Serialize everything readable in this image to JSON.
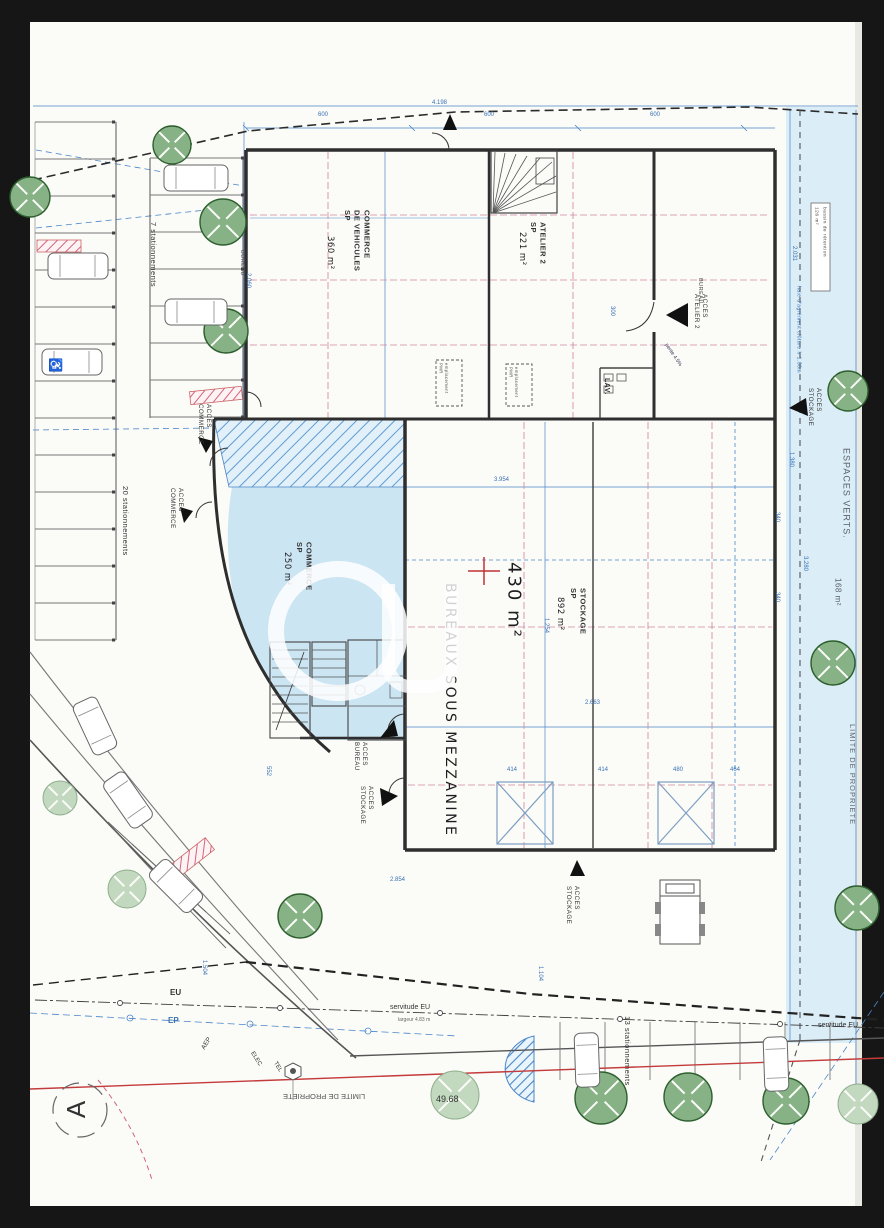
{
  "document": {
    "kind": "scanned site plan",
    "paper_color": "#fbfbf8",
    "frame_color": "#161616"
  },
  "colors": {
    "wall": "#2e2e2e",
    "blue_line": "#4a86c8",
    "blue_text": "#3a72b4",
    "pink_dash": "#d588a2",
    "red_line": "#c33b3b",
    "tree_dark": "#86b286",
    "tree_light": "#c2d9bf",
    "area_fill": "#cce5f2",
    "band_fill": "#dbedf7"
  },
  "labels": {
    "commerce_vehicules": "COMMERCE\nDE VEHICULES\nSP",
    "commerce_vehicules_area": "360 m²",
    "atelier2": "ATELIER 2\nSP",
    "atelier2_area": "221 m²",
    "stockage": "STOCKAGE\nSP",
    "stockage_area": "892 m²",
    "commerce": "COMMERCE\nSP",
    "commerce_area": "250 m²",
    "bureaux_mezzanine": "BUREAUX SOUS MEZZANINE",
    "bureaux_area": "430 m²",
    "lav": "LAV.",
    "bureau_1": "BUREAU",
    "bureau_2": "BUREAU",
    "acces_commerce_1": "ACCES\nCOMMERCE",
    "acces_commerce_2": "ACCES\nCOMMERCE",
    "acces_bureau": "ACCES\nBUREAU",
    "acces_stockage_1": "ACCES\nSTOCKAGE",
    "acces_stockage_2": "ACCES\nSTOCKAGE",
    "acces_stockage_3": "ACCES\nSTOCKAGE",
    "acces_atelier2": "ACCES\nATELIER 2",
    "espaces_verts": "ESPACES VERTS.",
    "espaces_verts_area": "168 m²",
    "limite_droite": "LIMITE DE PROPRIETE",
    "limite_bas": "LIMITE DE PROPRIETE",
    "bassin": "bassin de rétention\n126 m²",
    "haie": "haie d'agrément clôture h 1.80m",
    "stat_20": "20 stationnements",
    "stat_7": "7 stationnements",
    "stat_13": "13 stationnements",
    "servitude_eu_1": "servitude EU",
    "servitude_eu_2": "servitude EU",
    "servitude_note": "largeur 4.83 m",
    "eu": "EU",
    "ep": "EP",
    "cote_4968": "49.68",
    "aep": "AEP",
    "elec": "ELEC",
    "tel": "TEL",
    "pente": "pente 4.5%",
    "pmr_1": "emplacement\nPMR",
    "pmr_2": "emplacement\nPMR",
    "north": "A",
    "wheelchair": "♿"
  },
  "dim_labels": [
    {
      "t": "600",
      "x": 318,
      "y": 112,
      "r": 0
    },
    {
      "t": "600",
      "x": 484,
      "y": 112,
      "r": 0
    },
    {
      "t": "600",
      "x": 650,
      "y": 112,
      "r": 0
    },
    {
      "t": "4.198",
      "x": 432,
      "y": 100,
      "r": 0
    },
    {
      "t": "3.954",
      "x": 494,
      "y": 477,
      "r": 0
    },
    {
      "t": "1.254",
      "x": 549,
      "y": 618,
      "r": 90
    },
    {
      "t": "2.663",
      "x": 585,
      "y": 700,
      "r": 0
    },
    {
      "t": "414",
      "x": 507,
      "y": 767,
      "r": 0
    },
    {
      "t": "414",
      "x": 598,
      "y": 767,
      "r": 0
    },
    {
      "t": "480",
      "x": 673,
      "y": 767,
      "r": 0
    },
    {
      "t": "464",
      "x": 730,
      "y": 767,
      "r": 0
    },
    {
      "t": "340",
      "x": 780,
      "y": 512,
      "r": 90
    },
    {
      "t": "340",
      "x": 780,
      "y": 592,
      "r": 90
    },
    {
      "t": "2.031",
      "x": 797,
      "y": 246,
      "r": 90
    },
    {
      "t": "1.380",
      "x": 794,
      "y": 452,
      "r": 90
    },
    {
      "t": "2.060",
      "x": 251,
      "y": 273,
      "r": 90
    },
    {
      "t": "300",
      "x": 615,
      "y": 306,
      "r": 90
    },
    {
      "t": "1.504",
      "x": 207,
      "y": 960,
      "r": 90
    },
    {
      "t": "552",
      "x": 271,
      "y": 766,
      "r": 90
    },
    {
      "t": "3.280",
      "x": 808,
      "y": 556,
      "r": 90
    },
    {
      "t": "1.104",
      "x": 543,
      "y": 966,
      "r": 90
    },
    {
      "t": "2.854",
      "x": 390,
      "y": 877,
      "r": 0
    }
  ],
  "trees": [
    {
      "x": 172,
      "y": 145,
      "r": 19,
      "light": false
    },
    {
      "x": 30,
      "y": 197,
      "r": 20,
      "light": false
    },
    {
      "x": 223,
      "y": 222,
      "r": 23,
      "light": false
    },
    {
      "x": 226,
      "y": 331,
      "r": 22,
      "light": false
    },
    {
      "x": 848,
      "y": 391,
      "r": 20,
      "light": false
    },
    {
      "x": 833,
      "y": 663,
      "r": 22,
      "light": false
    },
    {
      "x": 857,
      "y": 908,
      "r": 22,
      "light": false
    },
    {
      "x": 300,
      "y": 916,
      "r": 22,
      "light": false
    },
    {
      "x": 601,
      "y": 1098,
      "r": 26,
      "light": false
    },
    {
      "x": 688,
      "y": 1097,
      "r": 24,
      "light": false
    },
    {
      "x": 786,
      "y": 1101,
      "r": 23,
      "light": false
    },
    {
      "x": 60,
      "y": 798,
      "r": 17,
      "light": true
    },
    {
      "x": 127,
      "y": 889,
      "r": 19,
      "light": true
    },
    {
      "x": 455,
      "y": 1095,
      "r": 24,
      "light": true
    },
    {
      "x": 858,
      "y": 1104,
      "r": 20,
      "light": true
    }
  ],
  "cars": [
    {
      "x": 196,
      "y": 178,
      "w": 64,
      "h": 26,
      "r": 0
    },
    {
      "x": 78,
      "y": 266,
      "w": 60,
      "h": 26,
      "r": 0
    },
    {
      "x": 72,
      "y": 362,
      "w": 60,
      "h": 26,
      "r": 0
    },
    {
      "x": 196,
      "y": 312,
      "w": 62,
      "h": 26,
      "r": 0
    },
    {
      "x": 95,
      "y": 726,
      "w": 56,
      "h": 26,
      "r": 65
    },
    {
      "x": 128,
      "y": 800,
      "w": 56,
      "h": 26,
      "r": 55
    },
    {
      "x": 176,
      "y": 886,
      "w": 56,
      "h": 26,
      "r": 45
    },
    {
      "x": 587,
      "y": 1060,
      "w": 54,
      "h": 24,
      "r": 88
    },
    {
      "x": 776,
      "y": 1064,
      "w": 54,
      "h": 24,
      "r": 88
    }
  ],
  "parking_rows": [
    {
      "dir": "h",
      "x": 35,
      "len": 81,
      "y0": 122,
      "step": 37,
      "n": 15,
      "dot": 112
    },
    {
      "dir": "h",
      "x": 150,
      "len": 93,
      "y0": 158,
      "step": 37,
      "n": 8,
      "dot": 241
    },
    {
      "dir": "v",
      "y": 1022,
      "len": 58,
      "x0": 560,
      "step": 45,
      "n": 7
    }
  ],
  "pink_hatches": [
    {
      "x": 37,
      "y": 240,
      "w": 44,
      "h": 12,
      "r": 0
    },
    {
      "x": 190,
      "y": 389,
      "w": 52,
      "h": 13,
      "r": -6
    },
    {
      "x": 158,
      "y": 854,
      "w": 58,
      "h": 15,
      "r": -38
    }
  ]
}
